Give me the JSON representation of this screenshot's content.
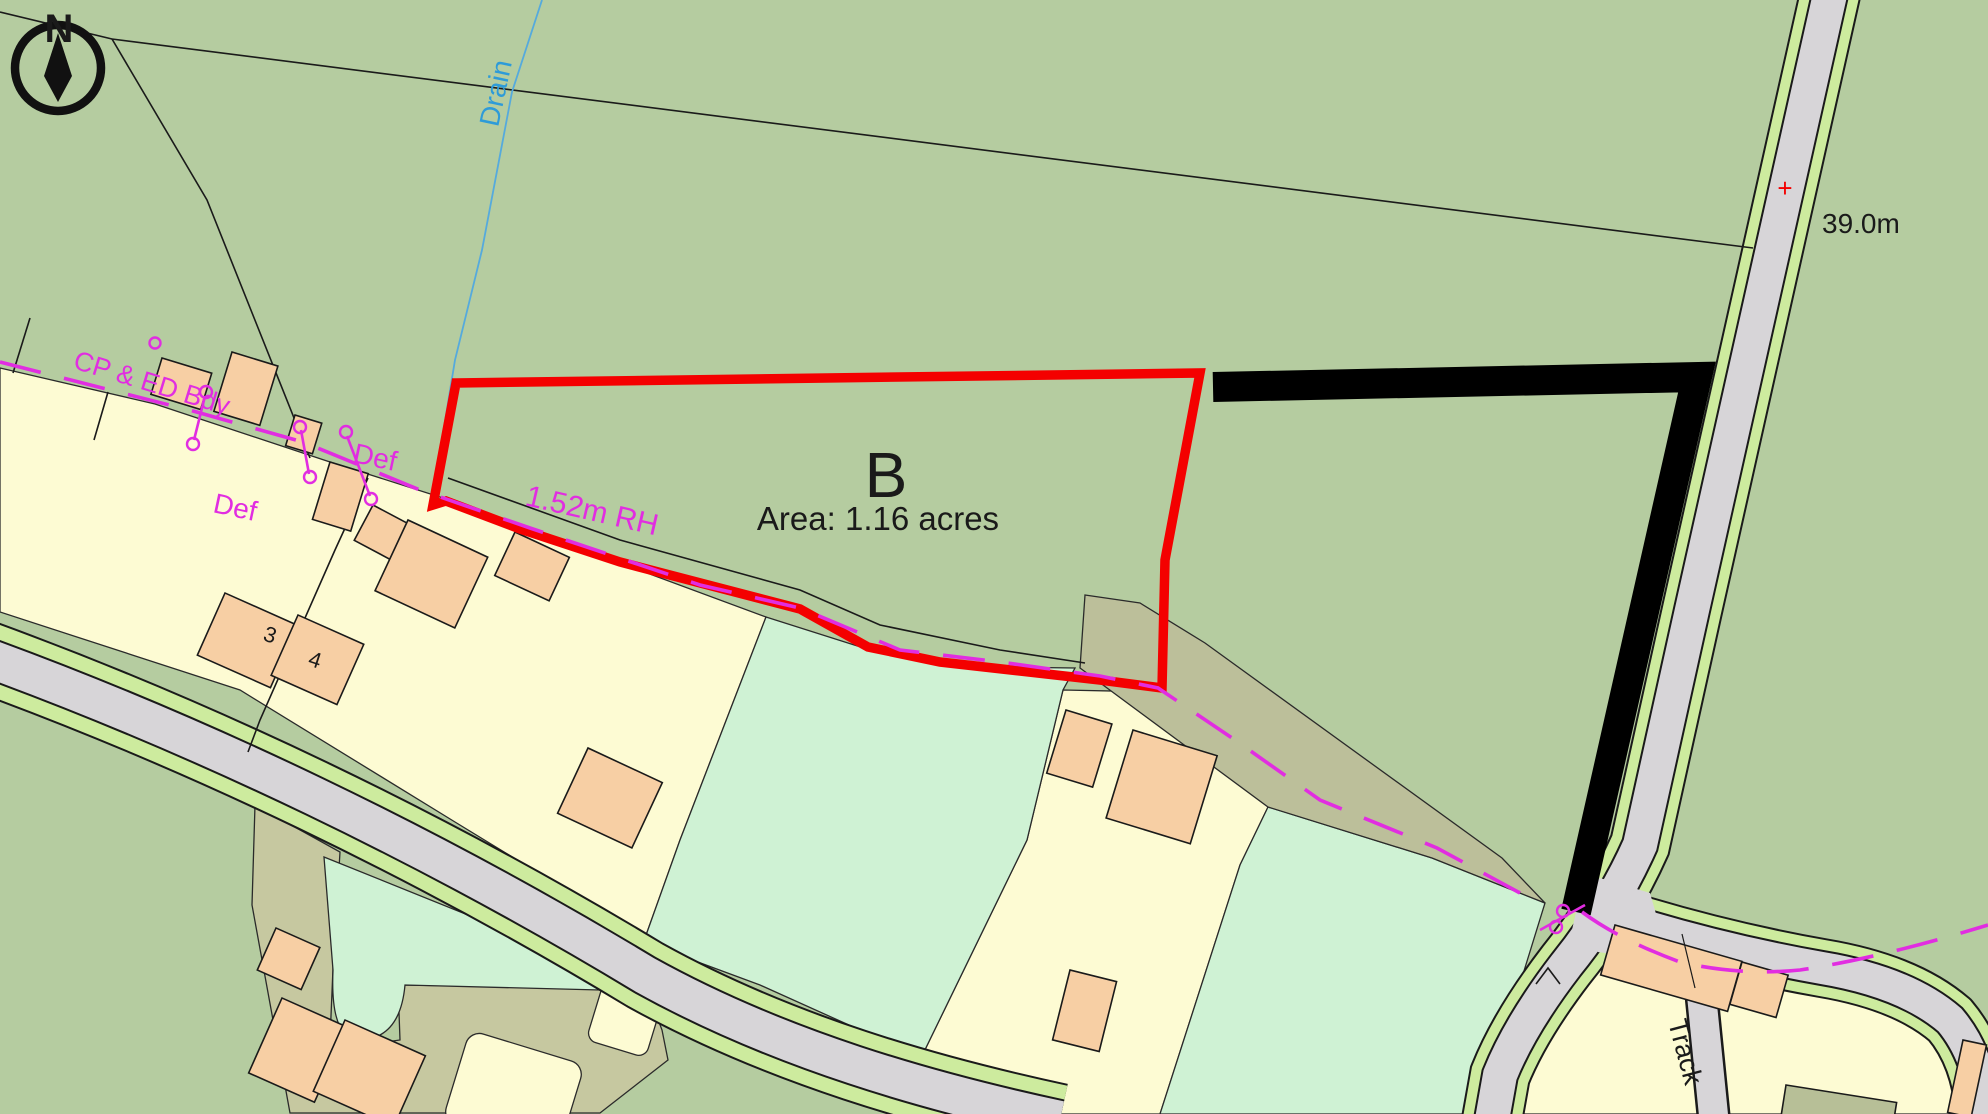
{
  "map": {
    "title": "Site plan with plot B boundary",
    "compass": {
      "label": "N"
    },
    "plot": {
      "id": "B",
      "area_label": "Area: 1.16 acres",
      "boundary_color": "#f40000",
      "other_boundary_color": "#000000"
    },
    "labels": {
      "drain": "Drain",
      "cp_ed_bdy": "CP & ED Bdy",
      "def_1": "Def",
      "def_2": "Def",
      "fence": "1.52m RH",
      "spot_height": "39.0m",
      "benchmark_cross": "+",
      "track": "Track",
      "house_3": "3",
      "house_4": "4"
    },
    "colors": {
      "field_green": "#b5cca0",
      "verge_green": "#cdeb9e",
      "road_grey": "#d7d5d8",
      "parcel_cream": "#fdfbd3",
      "parcel_mint": "#cff2d4",
      "building_peach": "#f7cfa4",
      "drive_khaki": "#c6c8a0",
      "drive_sage": "#bcbf9a",
      "building_sage": "#b7bf97",
      "plot_red": "#f40000",
      "annotation_magenta": "#e12de1",
      "water_blue": "#2e9bd8"
    }
  }
}
